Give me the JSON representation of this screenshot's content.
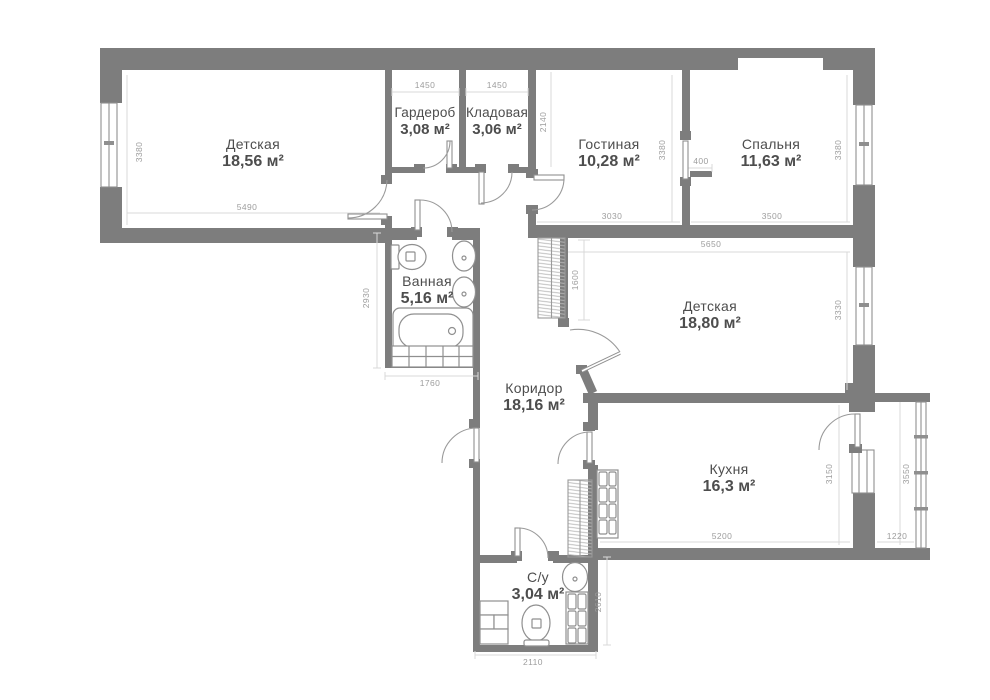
{
  "title": "Apartment floor plan",
  "colors": {
    "wall": "#7d7d7d",
    "dim_line": "#d9d9d9",
    "fixture": "#8f8f8f",
    "door": "#9a9a9a",
    "room_text": "#4d4d4d",
    "dim_text": "#9d9d9d",
    "background": "#ffffff"
  },
  "rooms": [
    {
      "name": "Детская",
      "area": "18,56 м²"
    },
    {
      "name": "Гардероб",
      "area": "3,08 м²"
    },
    {
      "name": "Кладовая",
      "area": "3,06 м²"
    },
    {
      "name": "Гостиная",
      "area": "10,28 м²"
    },
    {
      "name": "Спальня",
      "area": "11,63 м²"
    },
    {
      "name": "Ванная",
      "area": "5,16 м²"
    },
    {
      "name": "Детская",
      "area": "18,80 м²"
    },
    {
      "name": "Коридор",
      "area": "18,16 м²"
    },
    {
      "name": "Кухня",
      "area": "16,3 м²"
    },
    {
      "name": "С/у",
      "area": "3,04 м²"
    }
  ],
  "dims": [
    "3380",
    "5490",
    "1450",
    "1450",
    "2140",
    "3030",
    "3380",
    "400",
    "3500",
    "3380",
    "5650",
    "1600",
    "2930",
    "1760",
    "3330",
    "3150",
    "3550",
    "5200",
    "1220",
    "2610",
    "2110"
  ]
}
